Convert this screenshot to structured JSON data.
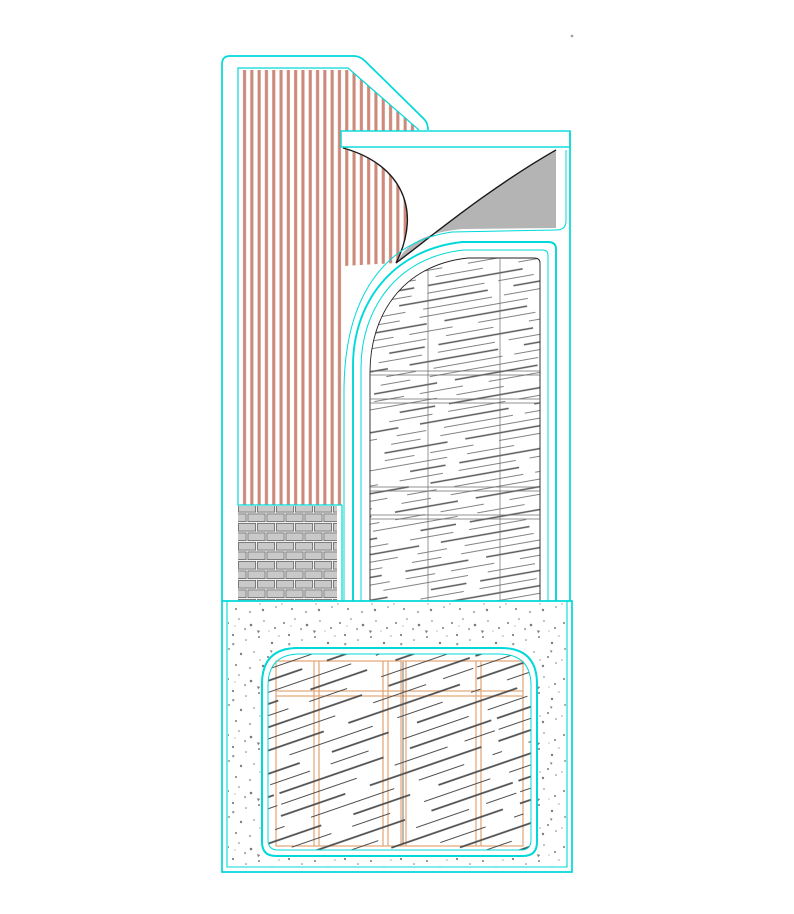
{
  "drawing": {
    "type": "cad-architectural-detail",
    "background": "#ffffff",
    "palette": {
      "outline_cyan": "#00d9d9",
      "siding_red": "#cd8a7a",
      "brick_fill": "#c9c9c9",
      "brick_joint": "#6f6f6f",
      "peel_gray": "#b4b4b4",
      "curve_black": "#1a1a1a",
      "hatch_gray": "#575757",
      "hatch_dark": "#4e4e4e",
      "grid_line_gray": "#6b6b6b",
      "grid_orange": "#e3aa7c",
      "stipple_gray": "#7c7c7c",
      "speck_dot": "#9aa8a6"
    },
    "regions": [
      {
        "name": "vertical-siding-panel",
        "material": "vertical-line-hatch",
        "color_ref": "siding_red"
      },
      {
        "name": "brick-course",
        "material": "running-bond-brick",
        "color_ref": "brick_fill"
      },
      {
        "name": "fascia-band",
        "material": "white-band-cyan-border",
        "color_ref": "outline_cyan"
      },
      {
        "name": "peeled-corner",
        "material": "page-peel-white-underside-with-gray-shadow",
        "color_ref": "peel_gray"
      },
      {
        "name": "arched-shake-panel",
        "material": "shallow-diagonal-shake-hatch-with-plank-grid",
        "color_ref": "hatch_gray"
      },
      {
        "name": "foundation-block",
        "material": "stippled-concrete",
        "color_ref": "stipple_gray"
      },
      {
        "name": "inner-framed-panel",
        "material": "diagonal-hatch-with-orange-stud-grid",
        "color_ref": "grid_orange"
      }
    ]
  }
}
